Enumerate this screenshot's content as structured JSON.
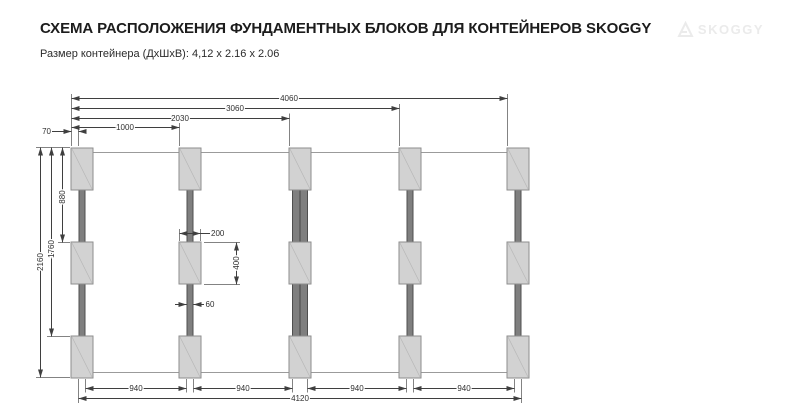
{
  "header": {
    "title": "СХЕМА РАСПОЛОЖЕНИЯ ФУНДАМЕНТНЫХ БЛОКОВ ДЛЯ КОНТЕЙНЕРОВ SKOGGY",
    "subtitle": "Размер контейнера (ДхШхВ): 4,12 x 2.16 x 2.06",
    "brand": "SKOGGY"
  },
  "dimensions": {
    "top_total": "4060",
    "top_to_col4": "3060",
    "top_to_col3": "2030",
    "top_to_col2": "1000",
    "edge_offset": "70",
    "height_total": "2160",
    "height_to_row3": "1760",
    "height_to_row2": "880",
    "block_width": "200",
    "block_height": "400",
    "beam_width": "60",
    "gap": "940",
    "bottom_total": "4120"
  },
  "colors": {
    "block_fill": "#d2d2d2",
    "beam_fill": "#7f7f7f",
    "line": "#3f3f3f",
    "brand_gray": "#ebebeb"
  }
}
